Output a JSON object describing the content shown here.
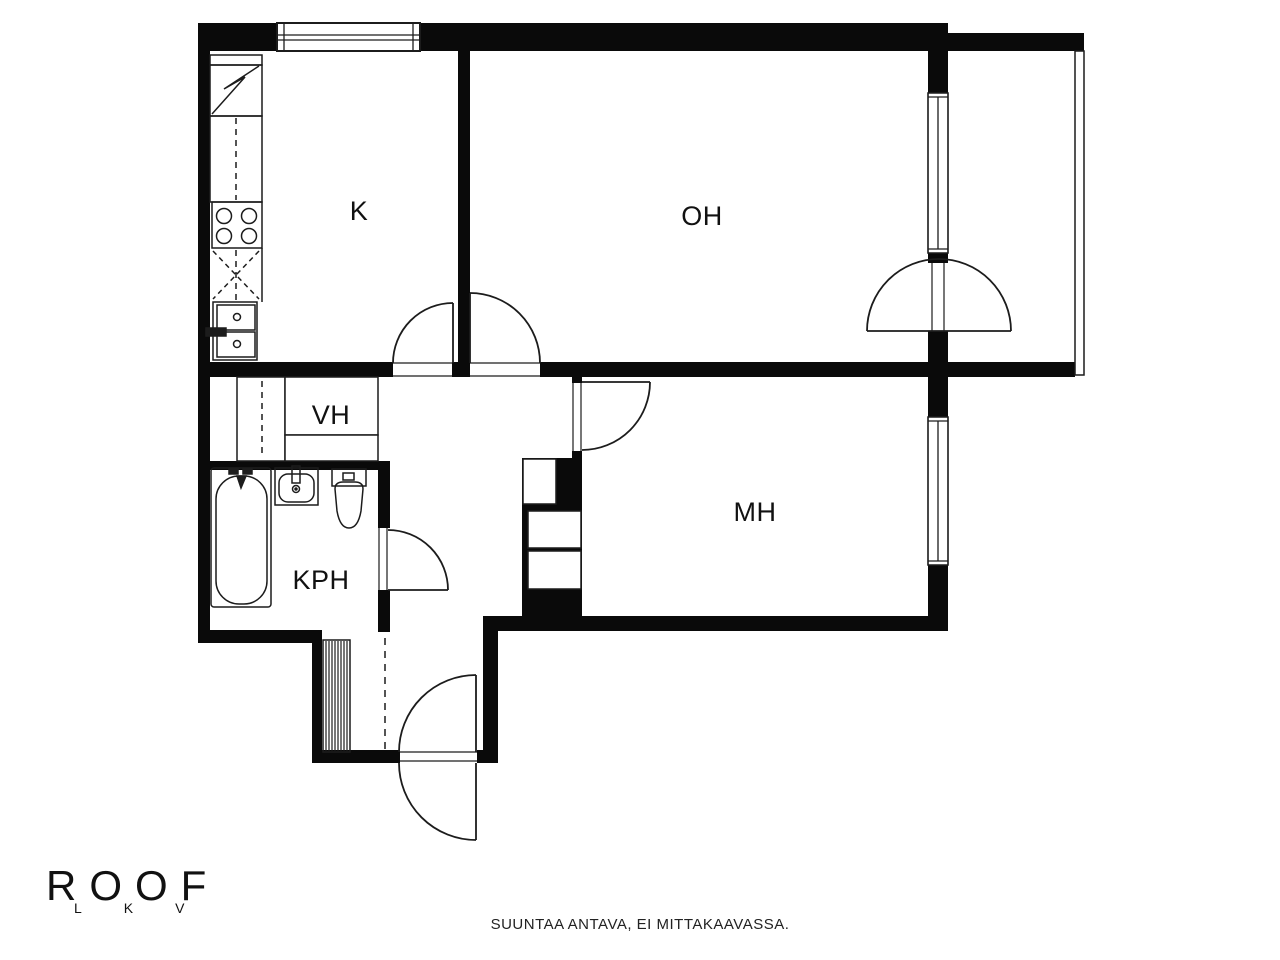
{
  "plan": {
    "rooms": {
      "kitchen": {
        "label": "K"
      },
      "living_room": {
        "label": "OH"
      },
      "wardrobe": {
        "label": "VH"
      },
      "bathroom": {
        "label": "KPH"
      },
      "bedroom": {
        "label": "MH"
      }
    }
  },
  "branding": {
    "logo": "ROOF",
    "logo_sub": "LKV"
  },
  "footer": {
    "disclaimer": "SUUNTAA ANTAVA, EI MITTAKAAVASSA."
  },
  "colors": {
    "background": "#ffffff",
    "wall": "#0a0a0a",
    "line": "#1c1c1c",
    "text": "#111111"
  }
}
